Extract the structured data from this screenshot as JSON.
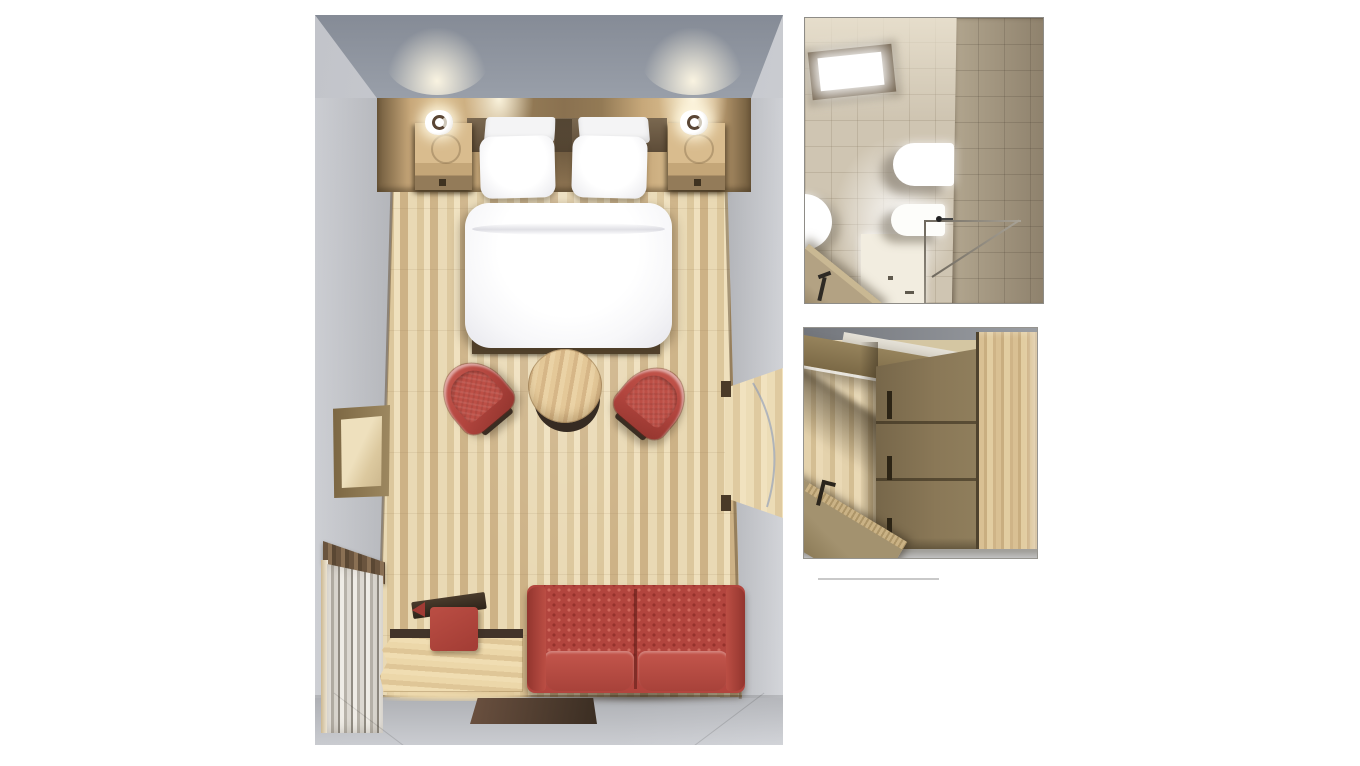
{
  "scene": {
    "type": "3d-floorplan-render",
    "description": "Top-down 3D renders of a hotel guest room with bathroom and wardrobe detail views",
    "panels": [
      {
        "id": "room",
        "label": "guest-room-top-view",
        "objects": [
          "headboard-panel",
          "wall-lamp-left",
          "wall-lamp-right",
          "nightstand-left",
          "nightstand-right",
          "double-bed",
          "pillows",
          "duvet",
          "footboard",
          "armchair-left",
          "armchair-right",
          "round-coffee-table",
          "wall-mirror",
          "curtain-window",
          "radiator",
          "luggage-bench",
          "ottoman-with-tray",
          "two-seat-sofa",
          "floor-mat",
          "entry-doorway",
          "door-swing-arc",
          "parquet-floor"
        ]
      },
      {
        "id": "bathroom",
        "label": "bathroom-top-view",
        "objects": [
          "skylight",
          "toilet",
          "bidet",
          "round-washbasin",
          "shower-tray",
          "shower-glass-screen",
          "shower-head",
          "open-door",
          "door-handle",
          "tiled-wall"
        ]
      },
      {
        "id": "wardrobe",
        "label": "wardrobe-top-view",
        "objects": [
          "wardrobe-doors",
          "door-handle-slots",
          "wardrobe-side-panel",
          "open-door",
          "door-handle",
          "parquet-floor"
        ]
      }
    ]
  },
  "colors": {
    "page_bg": "#ffffff",
    "wall_light": "#c7c9ce",
    "wall_dark": "#999fa9",
    "wall_darker": "#858b96",
    "glow_warm": "#fff8e4",
    "floor_light": "#e9d9b4",
    "floor_mid": "#dcc79c",
    "floor_dark": "#cdb286",
    "band_light": "#dcc193",
    "band_dark": "#6f5a3c",
    "wood_nightstand": "#d9bc8e",
    "wood_bench": "#ecd7a9",
    "wood_table": "#e4c898",
    "wood_edge_dark": "#55432d",
    "red_main": "#b2453e",
    "red_light": "#c6584e",
    "red_deep": "#93352e",
    "brown_dark": "#3a2d22",
    "white": "#ffffff",
    "mirror_frame": "#9d8860",
    "tile_wall": "#cfc5b2",
    "tile_dark": "#8e816c",
    "bath_door": "#b3a283",
    "ward_front": "#8a7857",
    "ward_top": "#d9c093",
    "ward_door": "#a3926f",
    "gray_strip": "#c9c9cb",
    "jamb": "#4a3a28",
    "arc_blue": "#7f94bc",
    "divider": "#c9c9c9"
  }
}
